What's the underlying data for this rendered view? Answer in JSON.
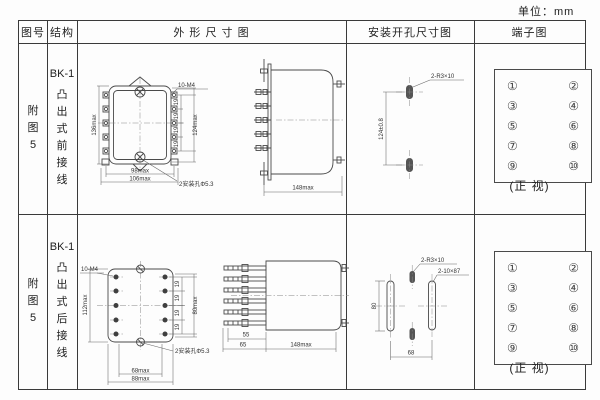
{
  "unit_label": "单位：mm",
  "headers": {
    "fig_no": "图号",
    "structure": "结构",
    "outline": "外 形 尺 寸 图",
    "install": "安装开孔尺寸图",
    "terminal": "端子图"
  },
  "rows": [
    {
      "fig_label": "附图5",
      "model": "BK-1",
      "structure_label": "凸出式前接线",
      "front_view": {
        "thread_label": "10-M4",
        "dim_height": "136max",
        "dim_terminal_span": "124max",
        "dim_pitch": "19",
        "dim_width_inner": "98max",
        "dim_width_outer": "106max",
        "hole_label": "2安装孔Φ5.3"
      },
      "side_view": {
        "dim_depth": "148max"
      },
      "install_view": {
        "dim_vertical": "124±0.8",
        "slot_label": "2-R3×10"
      },
      "terminal_view": {
        "caption": "(正 视)"
      }
    },
    {
      "fig_label": "附图5",
      "model": "BK-1",
      "structure_label": "凸出式后接线",
      "front_view": {
        "thread_label": "10-M4",
        "dim_height": "112max",
        "dim_terminal_span": "80max",
        "dim_pitch": "19",
        "dim_width_inner": "68max",
        "dim_width_outer": "88max",
        "hole_label": "2安装孔Φ5.3"
      },
      "side_view": {
        "dim_stud": "55",
        "dim_front": "65",
        "dim_depth": "148max"
      },
      "install_view": {
        "dim_vertical": "80",
        "dim_horizontal": "68",
        "slot_label_small": "2-R3×10",
        "slot_label_large": "2-10×87"
      },
      "terminal_view": {
        "caption": "(正 视)"
      }
    }
  ],
  "terminals": [
    "①",
    "②",
    "③",
    "④",
    "⑤",
    "⑥",
    "⑦",
    "⑧",
    "⑨",
    "⑩"
  ]
}
